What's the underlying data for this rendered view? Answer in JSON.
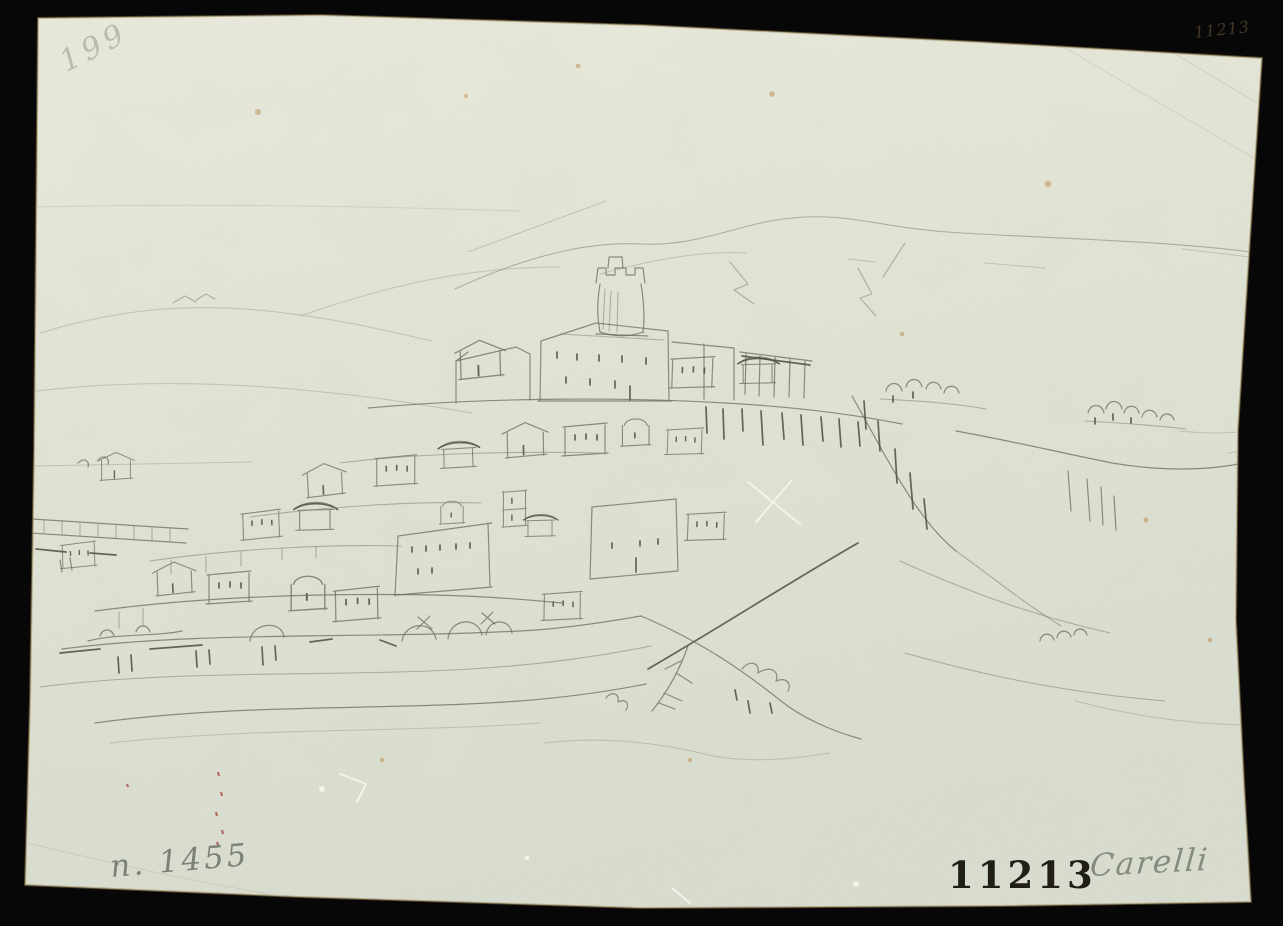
{
  "artwork": {
    "kind": "pencil drawing of a hilltop town photographed on a black backdrop",
    "inscriptions": {
      "top_left_pencil": "199",
      "top_right_handwritten": "11213",
      "bottom_left_pencil": "n. 1455",
      "stamp_number": "11213",
      "artist_signature": "Carelli"
    },
    "colors": {
      "backdrop": "#070707",
      "paper_light": "#edeee0",
      "paper_mid": "#e3e7d7",
      "paper_dark": "#dce1d2",
      "paper_edge": "#8f7a49",
      "pencil_light": "#80836f",
      "pencil_mid": "#6b6e5c",
      "pencil_dark": "#4c4f41",
      "ink": "#43372a",
      "stamp_ink": "#211e18",
      "foxing": "#b98a4e",
      "red_chalk": "#a33b2e"
    }
  }
}
